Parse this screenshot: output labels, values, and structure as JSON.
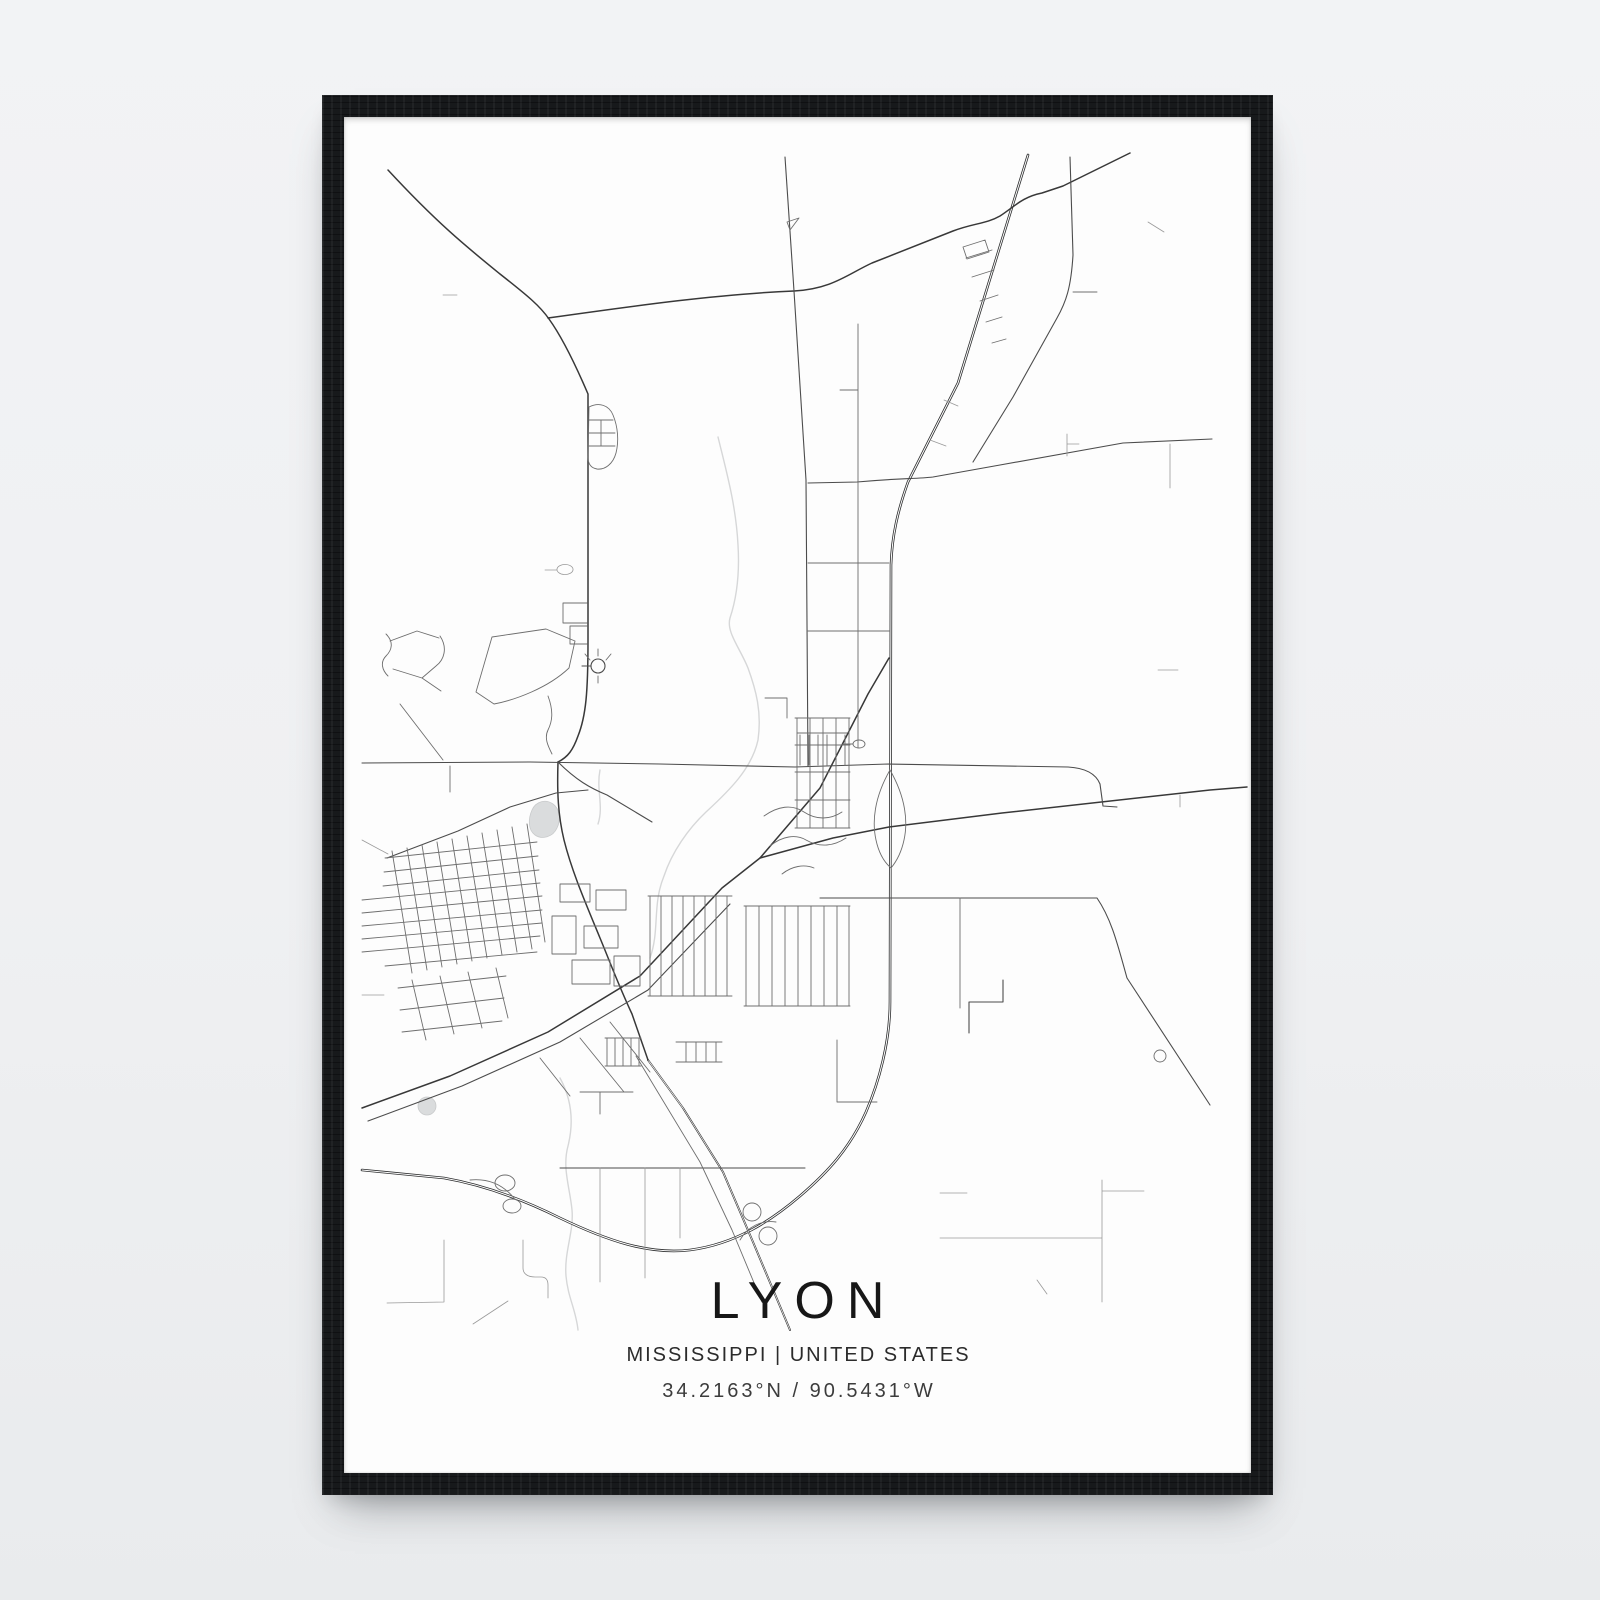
{
  "poster": {
    "title": "LYON",
    "subtitle": "MISSISSIPPI | UNITED STATES",
    "coordinates": "34.2163°N / 90.5431°W",
    "location": {
      "city": "Lyon",
      "state": "Mississippi",
      "country": "United States",
      "latitude": "34.2163°N",
      "longitude": "90.5431°W"
    }
  },
  "map": {
    "kind": "minimal-street-map",
    "road_color": "#3a3a3a",
    "highway_color": "#2c2d2e",
    "minor_road_color": "#6e6e6e",
    "water_color": "#d6d7d8",
    "paper_color": "#fdfdfd"
  },
  "frame": {
    "style": "black-wood-frame",
    "color": "#17191b",
    "wall_color": "#eff0f2"
  }
}
